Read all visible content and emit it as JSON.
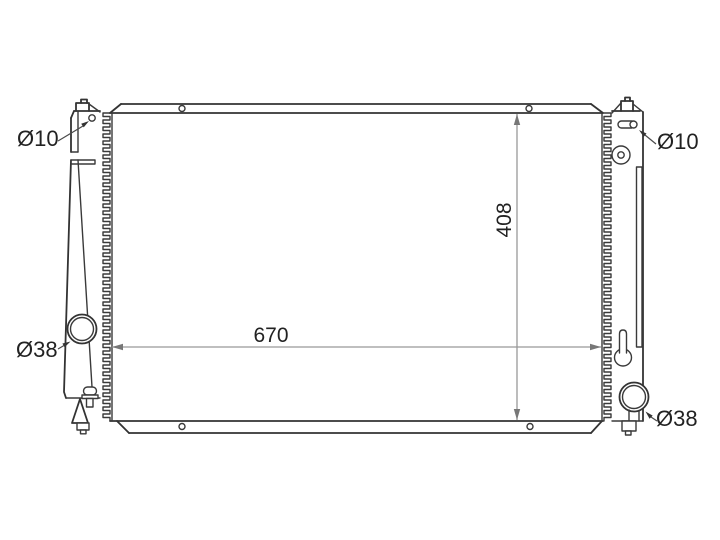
{
  "diagram": {
    "type": "radiator-technical-line-drawing",
    "labels": {
      "left_top_hole": "Ø10",
      "right_top_hole": "Ø10",
      "left_pipe": "Ø38",
      "right_pipe": "Ø38"
    },
    "dimensions": {
      "core_width": "670",
      "core_height": "408"
    },
    "colors": {
      "line": "#333333",
      "dimension_line": "#999999",
      "text": "#222222",
      "background": "#ffffff"
    }
  }
}
